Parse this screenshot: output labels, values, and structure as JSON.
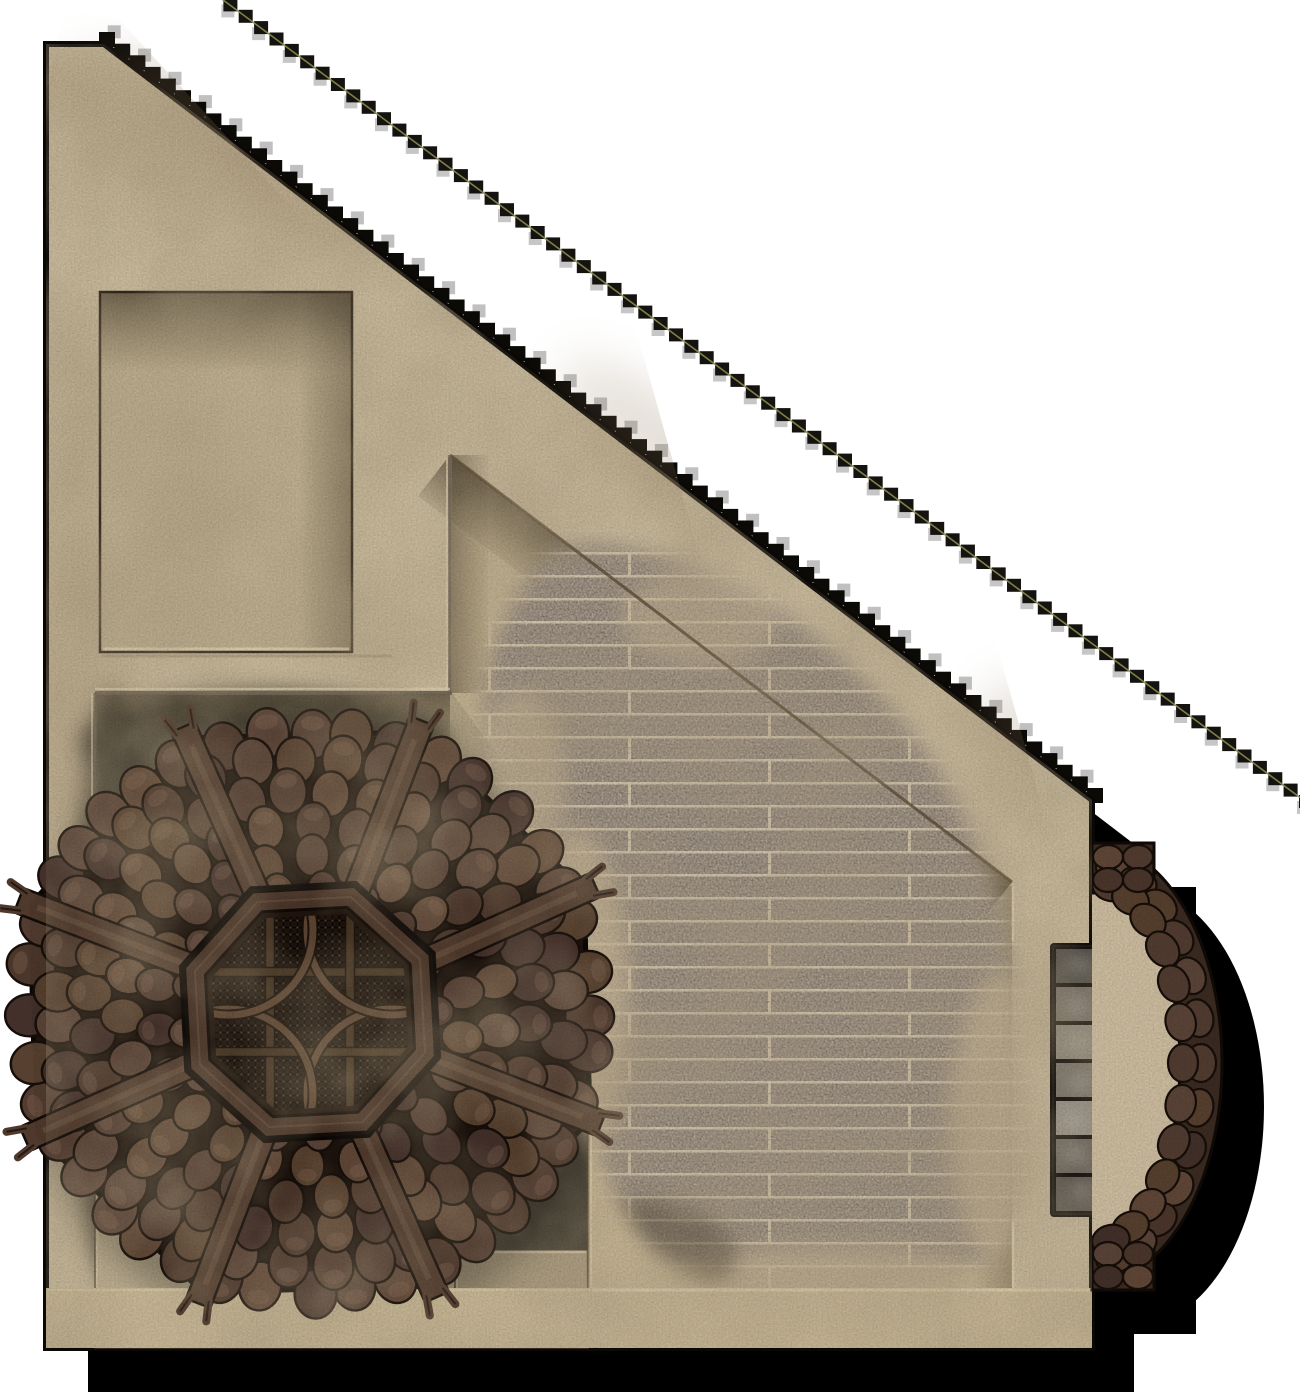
{
  "map": {
    "width": 1300,
    "height": 1400,
    "background_color": "#ffffff",
    "kind": "top-down fantasy battle-map tile: adobe building corner with octagonal shingled tower roof, sunken rooms, plank floor, stone steps and round shingled porch awning"
  },
  "palette": {
    "outline": "#0a0805",
    "shadow": "#000000",
    "wall": "#cbbc9e",
    "wall_stain": "#8a7354",
    "highlight": "#e2d5b3",
    "edge_dark": "#5f5140",
    "grain": "#000000"
  },
  "building": {
    "outline": [
      [
        46,
        44
      ],
      [
        104,
        44
      ],
      [
        1092,
        800
      ],
      [
        1092,
        1348
      ],
      [
        46,
        1348
      ]
    ],
    "outline_width": 6,
    "shadow_offset": [
      42,
      44
    ],
    "diag": {
      "x1": 104,
      "y1": 44,
      "x2": 1092,
      "y2": 800
    },
    "bottom_wall": {
      "rect": [
        46,
        1288,
        1046,
        60
      ],
      "fill": "#c9b997"
    }
  },
  "recess": {
    "rect": [
      100,
      292,
      252,
      360
    ],
    "fill": "#c0b191",
    "outline": "#332a1f",
    "shadow": "rgba(40,30,18,0.55)",
    "highlight": "#e5d8b6"
  },
  "room": {
    "points": [
      [
        450,
        455
      ],
      [
        1012,
        882
      ],
      [
        1012,
        1288
      ],
      [
        588,
        1288
      ],
      [
        588,
        1020
      ],
      [
        560,
        950
      ],
      [
        560,
        840
      ],
      [
        450,
        690
      ]
    ],
    "fill": "#c6b694",
    "light_patch": "#d4c5a5",
    "diag_shadow": "rgba(58,46,30,0.6)",
    "edge_dark": "#5a4b35",
    "edge_highlight": "#e0d3b2"
  },
  "courtyard": {
    "rect": [
      95,
      693,
      545,
      595
    ],
    "fill": "#b2a487",
    "grime": "#423d31",
    "grime_light": "#8d8471",
    "steps": [
      {
        "rect": [
          95,
          1135,
          205,
          213
        ],
        "fill": "#c2b395"
      },
      {
        "rect": [
          300,
          1192,
          155,
          156
        ],
        "fill": "#b8a98b"
      },
      {
        "rect": [
          455,
          1250,
          133,
          98
        ],
        "fill": "#ac9d80"
      }
    ]
  },
  "plank_floor": {
    "fill": "#7d7065",
    "gap": "#c6b69c",
    "dark_streak": "#6f6257",
    "sand": "#c9b897",
    "grime": "#4a3f30",
    "path": "M 540,560 C 480,640 470,720 500,800 C 520,860 545,880 550,960 C 555,1040 580,1120 620,1200 C 650,1260 700,1295 780,1298 C 880,1300 980,1285 1012,1240 C 1030,1180 1028,1100 1020,1020 C 1012,940 990,860 950,790 C 905,715 840,650 770,605 C 700,563 580,520 540,560 Z"
  },
  "roof": {
    "center": [
      310,
      1012
    ],
    "radius": 295,
    "base_fill": "#1c130d",
    "vertex_offset_deg": -69,
    "ring_radii": [
      122,
      155,
      188,
      221,
      254,
      280
    ],
    "shingle_palette": [
      "#57402f",
      "#4b362b",
      "#604737",
      "#43302a",
      "#523c31",
      "#5b4438"
    ],
    "shingle_outline": "#160e09",
    "shingle_highlight": "#8a6d58",
    "beams": {
      "angles_deg": [
        -69,
        -24,
        21,
        66,
        111,
        156,
        201,
        246
      ],
      "inner_r": 100,
      "outer_r": 312,
      "width": 26,
      "fill": "#4f392c",
      "outline": "#120b07",
      "streak": "#6a5140"
    },
    "skylight": {
      "outer_r": 133,
      "inner_r": 111,
      "mesh_r": 104,
      "frame_fill": "#4a3529",
      "frame_edge": "#0e0905",
      "mesh_bg": "#1c120c",
      "mesh_line": "#090605",
      "mesh_dot": "#4f3b27",
      "grid_fill": "#41301f",
      "grid_edge": "#140c07",
      "grid_offset": 40,
      "arc_color": "#5d4533",
      "arc_outline": "#170e08",
      "arc_center_offset": 82,
      "arc_radius": 85
    }
  },
  "porch": {
    "center": [
      1092,
      1063
    ],
    "floor_rx": 88,
    "floor_ry": 178,
    "outer_rx": 130,
    "outer_ry": 220,
    "floor_fill": "#cdbda0",
    "band_fill": "#3b2b22",
    "band_outline": "#100a06",
    "strip_top": [
      1092,
      843,
      62,
      50
    ],
    "strip_bottom": [
      1092,
      1240,
      62,
      50
    ],
    "shingle_rows": [
      [
        109,
        199
      ],
      [
        91,
        181
      ]
    ]
  },
  "steps": {
    "frame_rect": [
      1051,
      944,
      52,
      272
    ],
    "frame_fill": "#181410",
    "cell_x": 1055,
    "cell_y0": 948,
    "cell_w": 44,
    "cell_h": 36,
    "cell_stride": 38,
    "cells": [
      "#514f4a",
      "#767069",
      "#8f8a80",
      "#7d776e",
      "#9a948a",
      "#6e6962",
      "#5d5852"
    ],
    "shadow": "#7a6b55"
  },
  "rope": {
    "x1": 215,
    "y1": -6,
    "x2": 1306,
    "y2": 802,
    "color": "#141310",
    "core": "#8b8a52"
  },
  "effects": {
    "grain_opacity": 0.14,
    "clouds_opacity": 0.5
  }
}
